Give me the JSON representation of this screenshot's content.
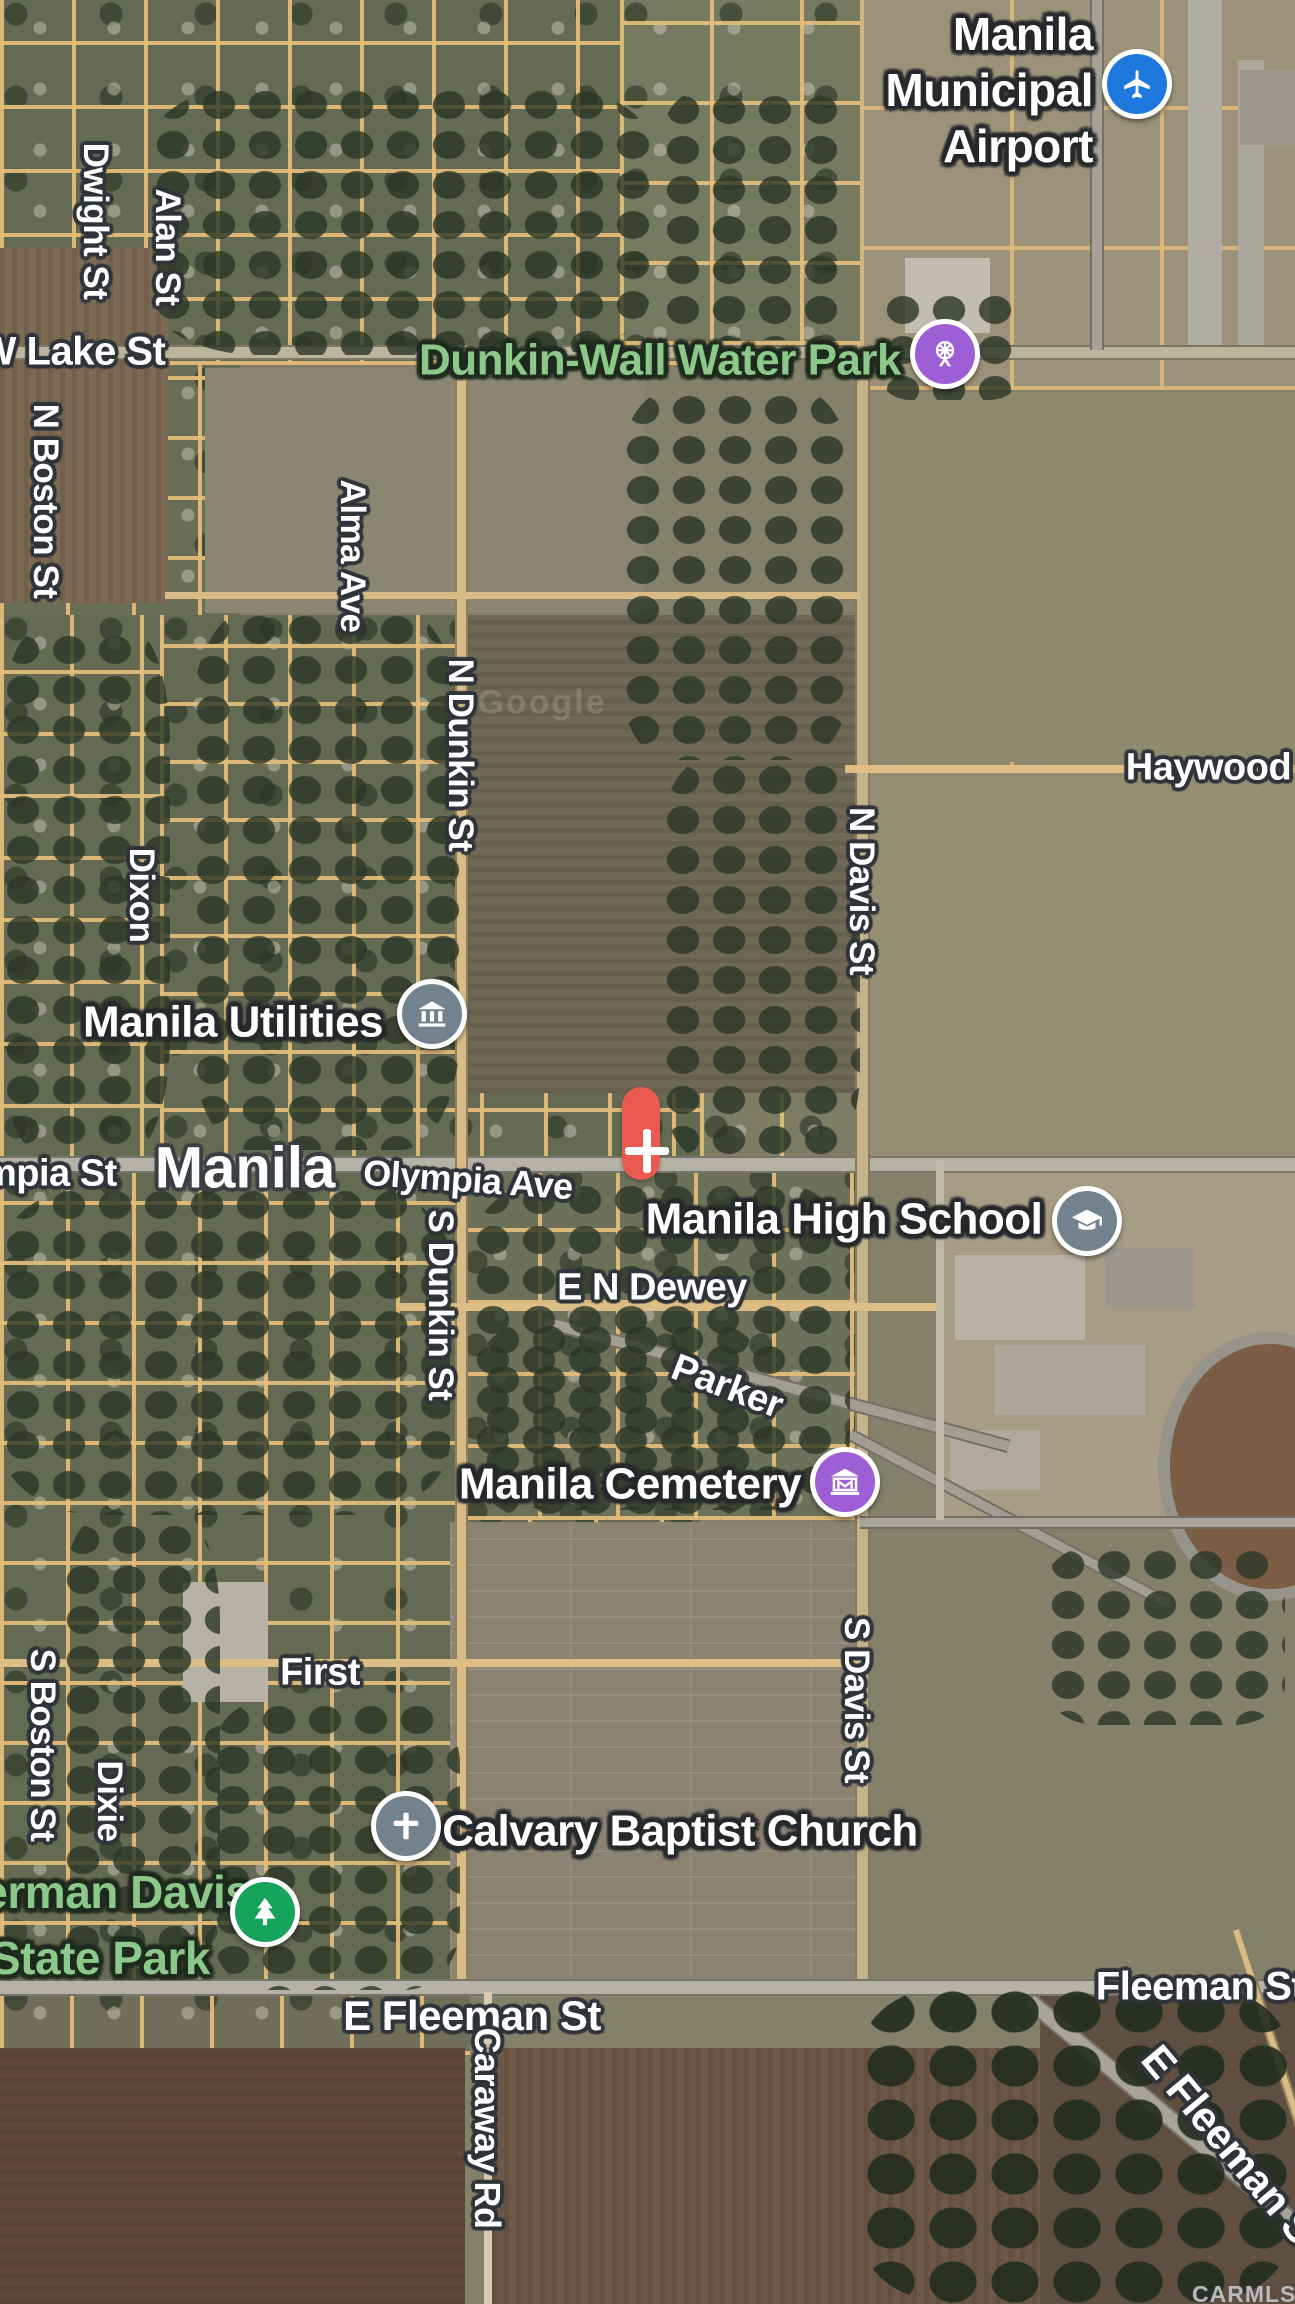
{
  "map": {
    "city_label": {
      "text": "Manila",
      "x": 245,
      "y": 1168
    },
    "street_labels": [
      {
        "text": "Dwight St",
        "x": 95,
        "y": 221,
        "rot": 90,
        "size": 35
      },
      {
        "text": "Alan St",
        "x": 167,
        "y": 247,
        "rot": 90,
        "size": 35
      },
      {
        "text": "W Lake St",
        "x": 72,
        "y": 352,
        "rot": 0,
        "size": 40
      },
      {
        "text": "N Boston St",
        "x": 45,
        "y": 501,
        "rot": 90,
        "size": 35
      },
      {
        "text": "Alma Ave",
        "x": 352,
        "y": 556,
        "rot": 90,
        "size": 35
      },
      {
        "text": "N Dunkin St",
        "x": 460,
        "y": 755,
        "rot": 90,
        "size": 35
      },
      {
        "text": "Dixon",
        "x": 141,
        "y": 895,
        "rot": 90,
        "size": 35
      },
      {
        "text": "N Davis St",
        "x": 861,
        "y": 891,
        "rot": 90,
        "size": 35
      },
      {
        "text": "Haywood St",
        "x": 1232,
        "y": 768,
        "rot": 0,
        "size": 38
      },
      {
        "text": "Olympia St",
        "x": 20,
        "y": 1174,
        "rot": 0,
        "size": 38
      },
      {
        "text": "Olympia Ave",
        "x": 468,
        "y": 1180,
        "rot": 4,
        "size": 36
      },
      {
        "text": "E N Dewey",
        "x": 652,
        "y": 1288,
        "rot": 0,
        "size": 38
      },
      {
        "text": "Parker",
        "x": 727,
        "y": 1387,
        "rot": 21,
        "size": 38
      },
      {
        "text": "S Dunkin St",
        "x": 440,
        "y": 1305,
        "rot": 90,
        "size": 35
      },
      {
        "text": "First",
        "x": 320,
        "y": 1673,
        "rot": 0,
        "size": 38
      },
      {
        "text": "S Boston St",
        "x": 42,
        "y": 1745,
        "rot": 90,
        "size": 35
      },
      {
        "text": "Dixie",
        "x": 109,
        "y": 1801,
        "rot": 90,
        "size": 35
      },
      {
        "text": "S Davis St",
        "x": 856,
        "y": 1700,
        "rot": 90,
        "size": 35
      },
      {
        "text": "E Fleeman St",
        "x": 472,
        "y": 2016,
        "rot": 0,
        "size": 42
      },
      {
        "text": "Fleeman St",
        "x": 1200,
        "y": 1987,
        "rot": 0,
        "size": 40
      },
      {
        "text": "E Fleeman St",
        "x": 1233,
        "y": 2150,
        "rot": 50,
        "size": 42
      },
      {
        "text": "Caraway Rd",
        "x": 487,
        "y": 2128,
        "rot": 90,
        "size": 36
      }
    ],
    "pois": [
      {
        "label_lines": [
          "Manila",
          "Municipal",
          "Airport"
        ],
        "label_x": 1093,
        "label_y": 90,
        "align": "right",
        "size": 46,
        "line_height": 1.22,
        "icon": "airport-icon",
        "icon_x": 1137,
        "icon_y": 84,
        "icon_color": "#1e78dd",
        "theme": "white"
      },
      {
        "label_lines": [
          "Dunkin-Wall Water Park"
        ],
        "label_x": 660,
        "label_y": 361,
        "size": 44,
        "line_height": 1.2,
        "icon": "water-park-icon",
        "icon_x": 945,
        "icon_y": 354,
        "icon_color": "#9e5fd6",
        "theme": "green"
      },
      {
        "label_lines": [
          "Manila Utilities"
        ],
        "label_x": 233,
        "label_y": 1023,
        "size": 44,
        "line_height": 1.2,
        "icon": "utilities-icon",
        "icon_x": 432,
        "icon_y": 1014,
        "icon_color": "#72838e",
        "theme": "white"
      },
      {
        "label_lines": [
          "Manila High School"
        ],
        "label_x": 844,
        "label_y": 1220,
        "size": 44,
        "line_height": 1.2,
        "icon": "school-icon",
        "icon_x": 1087,
        "icon_y": 1221,
        "icon_color": "#72838e",
        "theme": "white"
      },
      {
        "label_lines": [
          "Manila Cemetery"
        ],
        "label_x": 630,
        "label_y": 1485,
        "size": 44,
        "line_height": 1.2,
        "icon": "cemetery-icon",
        "icon_x": 845,
        "icon_y": 1482,
        "icon_color": "#9e5fd6",
        "theme": "white"
      },
      {
        "label_lines": [
          "Calvary Baptist Church"
        ],
        "label_x": 680,
        "label_y": 1832,
        "size": 44,
        "line_height": 1.2,
        "icon": "church-icon",
        "icon_x": 406,
        "icon_y": 1826,
        "icon_color": "#72838e",
        "theme": "white"
      },
      {
        "label_lines": [
          "Herman Davis",
          "State Park"
        ],
        "label_x": 100,
        "label_y": 1926,
        "size": 46,
        "line_height": 1.43,
        "icon": "park-icon",
        "icon_x": 265,
        "icon_y": 1912,
        "icon_color": "#16a35c",
        "theme": "green"
      }
    ],
    "marker": {
      "color": "#ea5a4e",
      "symbol": "plus"
    },
    "watermarks": {
      "imagery": "Google",
      "attribution": "CARMLS, INC"
    },
    "colors": {
      "pin_blue": "#1e78dd",
      "pin_purple": "#9e5fd6",
      "pin_slate": "#72838e",
      "pin_green": "#16a35c",
      "park_text_green": "#8bc88a",
      "road_tan": "#e0bd83",
      "marker_red": "#ea5a4e"
    }
  }
}
